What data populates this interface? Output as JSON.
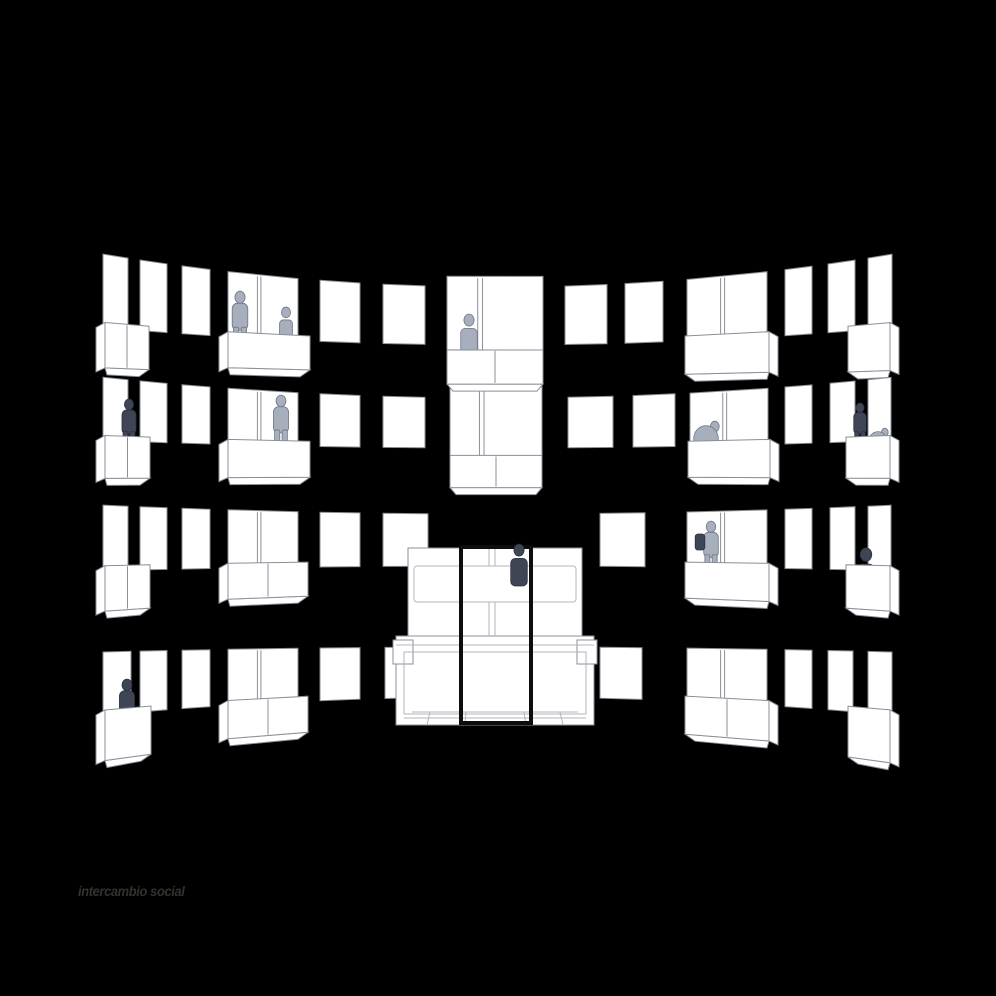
{
  "caption": {
    "text": "intercambio social"
  },
  "colors": {
    "background": "#000000",
    "windowFill": "#ffffff",
    "outline": "#8a8f99",
    "outlineSoft": "#b0b4bc",
    "figureLight": "#a7aebc",
    "figureLightStroke": "#6e7687",
    "figureDark": "#3e4554",
    "figureDarkStroke": "#2c3140",
    "frame": "#0d0d0d",
    "caption": "#33332e"
  },
  "scene": {
    "cx": 498,
    "halfSpan": 407,
    "horizon": 560,
    "bow": 0.11,
    "grow": 0.28,
    "rows": [
      {
        "id": "floor-4",
        "mid": 316,
        "half": 29,
        "units": [
          {
            "x": 103,
            "w": 25,
            "kind": "tall",
            "balcony": {
              "x": 105,
              "w": 44,
              "h": 36,
              "div": true,
              "side": "left"
            }
          },
          {
            "x": 140,
            "w": 27,
            "kind": "tall"
          },
          {
            "x": 182,
            "w": 28,
            "kind": "tall"
          },
          {
            "x": 228,
            "w": 70,
            "kind": "wide",
            "balcony": {
              "x": 228,
              "w": 82,
              "h": 32,
              "div": false,
              "side": "left"
            }
          },
          {
            "x": 320,
            "w": 40,
            "kind": "sq"
          },
          {
            "x": 383,
            "w": 42,
            "kind": "sq"
          },
          {
            "x": 447,
            "w": 96,
            "kind": "center",
            "stretch": 1.35,
            "balcony": {
              "x": 447,
              "w": 96,
              "h": 34,
              "div": true,
              "side": "none"
            }
          },
          {
            "x": 565,
            "w": 42,
            "kind": "sq"
          },
          {
            "x": 625,
            "w": 38,
            "kind": "sq"
          },
          {
            "x": 687,
            "w": 80,
            "kind": "wide",
            "balcony": {
              "x": 685,
              "w": 84,
              "h": 36,
              "div": false,
              "side": "right"
            }
          },
          {
            "x": 785,
            "w": 27,
            "kind": "tall"
          },
          {
            "x": 828,
            "w": 27,
            "kind": "tall"
          },
          {
            "x": 868,
            "w": 24,
            "kind": "tall",
            "balcony": {
              "x": 848,
              "w": 42,
              "h": 38,
              "div": false,
              "side": "right"
            }
          }
        ]
      },
      {
        "id": "floor-3",
        "mid": 423,
        "half": 25,
        "units": [
          {
            "x": 103,
            "w": 25,
            "kind": "tall",
            "balcony": {
              "x": 105,
              "w": 45,
              "h": 34,
              "div": true,
              "side": "left"
            }
          },
          {
            "x": 140,
            "w": 27,
            "kind": "tall"
          },
          {
            "x": 182,
            "w": 28,
            "kind": "tall"
          },
          {
            "x": 228,
            "w": 70,
            "kind": "wide",
            "balcony": {
              "x": 228,
              "w": 82,
              "h": 34,
              "div": false,
              "side": "left"
            }
          },
          {
            "x": 320,
            "w": 40,
            "kind": "sq"
          },
          {
            "x": 383,
            "w": 42,
            "kind": "sq"
          },
          {
            "x": 450,
            "w": 92,
            "kind": "center",
            "stretch": 1.5,
            "balcony": {
              "x": 450,
              "w": 92,
              "h": 32,
              "div": true,
              "side": "none"
            }
          },
          {
            "x": 568,
            "w": 45,
            "kind": "sq"
          },
          {
            "x": 633,
            "w": 42,
            "kind": "sq"
          },
          {
            "x": 690,
            "w": 78,
            "kind": "wide",
            "balcony": {
              "x": 688,
              "w": 82,
              "h": 34,
              "div": false,
              "side": "right"
            }
          },
          {
            "x": 785,
            "w": 27,
            "kind": "tall"
          },
          {
            "x": 830,
            "w": 25,
            "kind": "tall"
          },
          {
            "x": 868,
            "w": 23,
            "kind": "tall",
            "balcony": {
              "x": 846,
              "w": 44,
              "h": 34,
              "div": false,
              "side": "right"
            }
          }
        ]
      },
      {
        "id": "floor-2",
        "mid": 540,
        "half": 26,
        "units": [
          {
            "x": 103,
            "w": 25,
            "kind": "tall",
            "balcony": {
              "x": 105,
              "w": 45,
              "h": 36,
              "div": true,
              "side": "left"
            }
          },
          {
            "x": 140,
            "w": 27,
            "kind": "tall"
          },
          {
            "x": 182,
            "w": 28,
            "kind": "tall"
          },
          {
            "x": 228,
            "w": 70,
            "kind": "wide",
            "balcony": {
              "x": 228,
              "w": 80,
              "h": 32,
              "div": true,
              "side": "left"
            }
          },
          {
            "x": 320,
            "w": 40,
            "kind": "sq"
          },
          {
            "x": 383,
            "w": 45,
            "kind": "sq"
          },
          {
            "x": 600,
            "w": 45,
            "kind": "sq"
          },
          {
            "x": 687,
            "w": 80,
            "kind": "wide",
            "balcony": {
              "x": 685,
              "w": 84,
              "h": 34,
              "div": false,
              "side": "right"
            }
          },
          {
            "x": 785,
            "w": 27,
            "kind": "tall"
          },
          {
            "x": 830,
            "w": 25,
            "kind": "tall"
          },
          {
            "x": 868,
            "w": 23,
            "kind": "tall",
            "balcony": {
              "x": 846,
              "w": 44,
              "h": 36,
              "div": false,
              "side": "right"
            }
          }
        ]
      },
      {
        "id": "floor-1",
        "mid": 672,
        "half": 25,
        "units": [
          {
            "x": 103,
            "w": 28,
            "kind": "tall",
            "balcony": {
              "x": 105,
              "w": 46,
              "h": 40,
              "div": false,
              "side": "left"
            }
          },
          {
            "x": 140,
            "w": 27,
            "kind": "tall"
          },
          {
            "x": 182,
            "w": 28,
            "kind": "tall"
          },
          {
            "x": 228,
            "w": 70,
            "kind": "wide",
            "balcony": {
              "x": 228,
              "w": 80,
              "h": 34,
              "div": true,
              "side": "left"
            }
          },
          {
            "x": 320,
            "w": 40,
            "kind": "sq"
          },
          {
            "x": 385,
            "w": 38,
            "kind": "sq"
          },
          {
            "x": 600,
            "w": 42,
            "kind": "sq"
          },
          {
            "x": 687,
            "w": 80,
            "kind": "wide",
            "balcony": {
              "x": 685,
              "w": 84,
              "h": 36,
              "div": true,
              "side": "right"
            }
          },
          {
            "x": 785,
            "w": 27,
            "kind": "tall"
          },
          {
            "x": 828,
            "w": 25,
            "kind": "tall"
          },
          {
            "x": 868,
            "w": 24,
            "kind": "tall",
            "balcony": {
              "x": 848,
              "w": 42,
              "h": 42,
              "div": false,
              "side": "right"
            }
          }
        ]
      }
    ],
    "figures": [
      {
        "x": 240,
        "yBase": 350,
        "h": 60,
        "kind": "stand",
        "shade": "light",
        "layer": "behind"
      },
      {
        "x": 286,
        "yBase": 342,
        "h": 38,
        "kind": "sit",
        "shade": "light",
        "layer": "behind"
      },
      {
        "x": 469,
        "yBase": 356,
        "h": 46,
        "kind": "torso",
        "shade": "light",
        "layer": "behind"
      },
      {
        "x": 129,
        "yBase": 452,
        "h": 54,
        "kind": "stand",
        "shade": "dark",
        "layer": "behind"
      },
      {
        "x": 281,
        "yBase": 452,
        "h": 58,
        "kind": "stand",
        "shade": "light",
        "layer": "behind"
      },
      {
        "x": 706,
        "yBase": 452,
        "h": 44,
        "kind": "crouch",
        "shade": "light",
        "layer": "behind"
      },
      {
        "x": 860,
        "yBase": 450,
        "h": 48,
        "kind": "stand",
        "shade": "dark",
        "layer": "behind"
      },
      {
        "x": 878,
        "yBase": 452,
        "h": 34,
        "kind": "crouch",
        "shade": "light",
        "layer": "behind"
      },
      {
        "x": 711,
        "yBase": 576,
        "h": 56,
        "kind": "stand",
        "shade": "light",
        "layer": "behind"
      },
      {
        "x": 700,
        "yBase": 550,
        "h": 16,
        "kind": "bag",
        "shade": "dark",
        "layer": "front"
      },
      {
        "x": 866,
        "yBase": 592,
        "h": 48,
        "kind": "sit",
        "shade": "dark",
        "layer": "behind"
      },
      {
        "x": 127,
        "yBase": 736,
        "h": 58,
        "kind": "stand",
        "shade": "dark",
        "layer": "behind"
      }
    ],
    "structure": {
      "boxes": [
        {
          "x": 408,
          "y": 548,
          "w": 174,
          "h": 90,
          "name": "upper-volume"
        },
        {
          "x": 396,
          "y": 636,
          "w": 198,
          "h": 89,
          "name": "lower-volume"
        },
        {
          "x": 393,
          "y": 640,
          "w": 20,
          "h": 24,
          "name": "left-tab"
        },
        {
          "x": 577,
          "y": 640,
          "w": 20,
          "h": 24,
          "name": "right-tab"
        }
      ],
      "outlineBoxes": [
        {
          "x": 414,
          "y": 566,
          "w": 162,
          "h": 36,
          "rx": 3,
          "name": "parapet"
        },
        {
          "x": 404,
          "y": 652,
          "w": 182,
          "h": 62,
          "rx": 0,
          "name": "pit"
        }
      ],
      "lines": [
        [
          489,
          548,
          489,
          566
        ],
        [
          495,
          548,
          495,
          566
        ],
        [
          489,
          602,
          489,
          636
        ],
        [
          495,
          602,
          495,
          636
        ],
        [
          396,
          645,
          594,
          645
        ],
        [
          412,
          712,
          578,
          712
        ],
        [
          404,
          718,
          586,
          718
        ],
        [
          430,
          712,
          427,
          725
        ],
        [
          466,
          712,
          465,
          725
        ],
        [
          524,
          712,
          526,
          725
        ],
        [
          560,
          712,
          563,
          725
        ]
      ],
      "frame": {
        "x": 461,
        "y": 547,
        "w": 70,
        "h": 176,
        "strokeWidth": 4
      },
      "figure": {
        "x": 519,
        "yBase": 586,
        "h": 46,
        "kind": "torso",
        "shade": "dark"
      }
    }
  }
}
